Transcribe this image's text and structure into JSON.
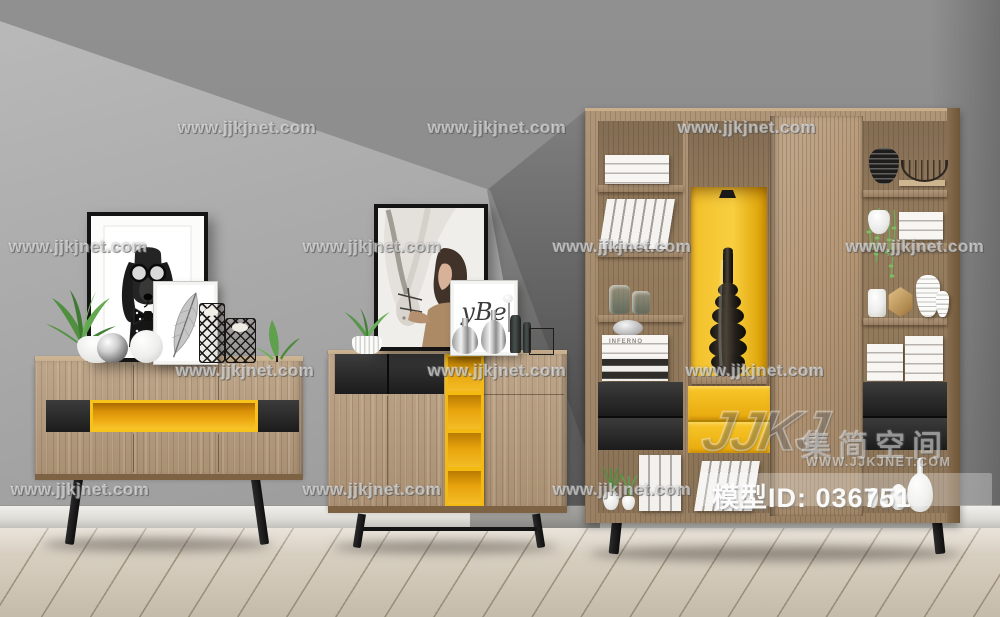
{
  "image_type": "3d-interior-furniture-render",
  "watermark": {
    "text": "www.jjkjnet.com",
    "positions": [
      {
        "x": 247,
        "y": 128
      },
      {
        "x": 497,
        "y": 128
      },
      {
        "x": 747,
        "y": 128
      },
      {
        "x": 78,
        "y": 247
      },
      {
        "x": 372,
        "y": 247
      },
      {
        "x": 622,
        "y": 247
      },
      {
        "x": 915,
        "y": 247
      },
      {
        "x": 245,
        "y": 371
      },
      {
        "x": 497,
        "y": 371
      },
      {
        "x": 755,
        "y": 371
      },
      {
        "x": 80,
        "y": 490
      },
      {
        "x": 372,
        "y": 490
      },
      {
        "x": 622,
        "y": 490
      }
    ]
  },
  "brand": {
    "logo_mark": "JJKJ",
    "name_cn": "集简空间",
    "site": "WWW.JJKJNET.COM"
  },
  "model_id": {
    "label": "模型ID:  036751"
  },
  "decor_text": {
    "book_spine": "INFERNO",
    "small_frame_script": "yBe"
  },
  "palette": {
    "accent_yellow": "#F3BB12",
    "wood": "#B79C7D",
    "panel_black": "#1F1F1F",
    "wall_gray": "#8F8F8F",
    "floor": "#D6CEC0"
  },
  "scene": {
    "furniture": [
      {
        "id": "left-sideboard",
        "desc": "low wood sideboard, black side panels flanking a yellow open niche, splayed black legs"
      },
      {
        "id": "middle-sideboard",
        "desc": "taller wood sideboard, two black drawers, vertical yellow open shelf column, black legs with stretcher"
      },
      {
        "id": "right-bookshelf",
        "desc": "large wood shelving unit, yellow display niche with dark gourd vase, yellow and black drawers, sliding wood door"
      }
    ],
    "decor": [
      "dog-portrait-frame",
      "feather-art-frame",
      "horse-portrait-frame",
      "script-art-frame",
      "potted-plants",
      "chrome-and-white-spheres",
      "lattice-candle-holders",
      "chrome-vases",
      "glass-bottles",
      "white-book-stacks",
      "glass-jars",
      "silver-canister",
      "woven-vase",
      "wire-basket",
      "hanging-vine-plant",
      "striped-vases",
      "gold-faceted-jar",
      "white-vases"
    ]
  }
}
